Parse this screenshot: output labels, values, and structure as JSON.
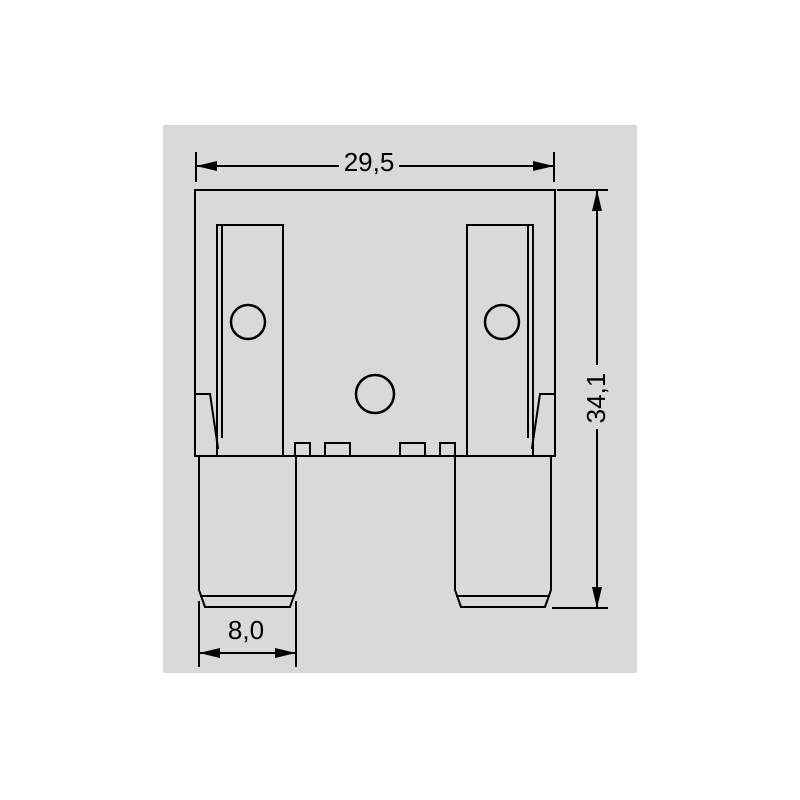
{
  "drawing": {
    "dim_overall_width": "29,5",
    "dim_overall_height": "34,1",
    "dim_terminal_width": "8,0",
    "colors": {
      "page_background": "#ffffff",
      "panel_background": "#d9d9d9",
      "line": "#000000"
    }
  }
}
